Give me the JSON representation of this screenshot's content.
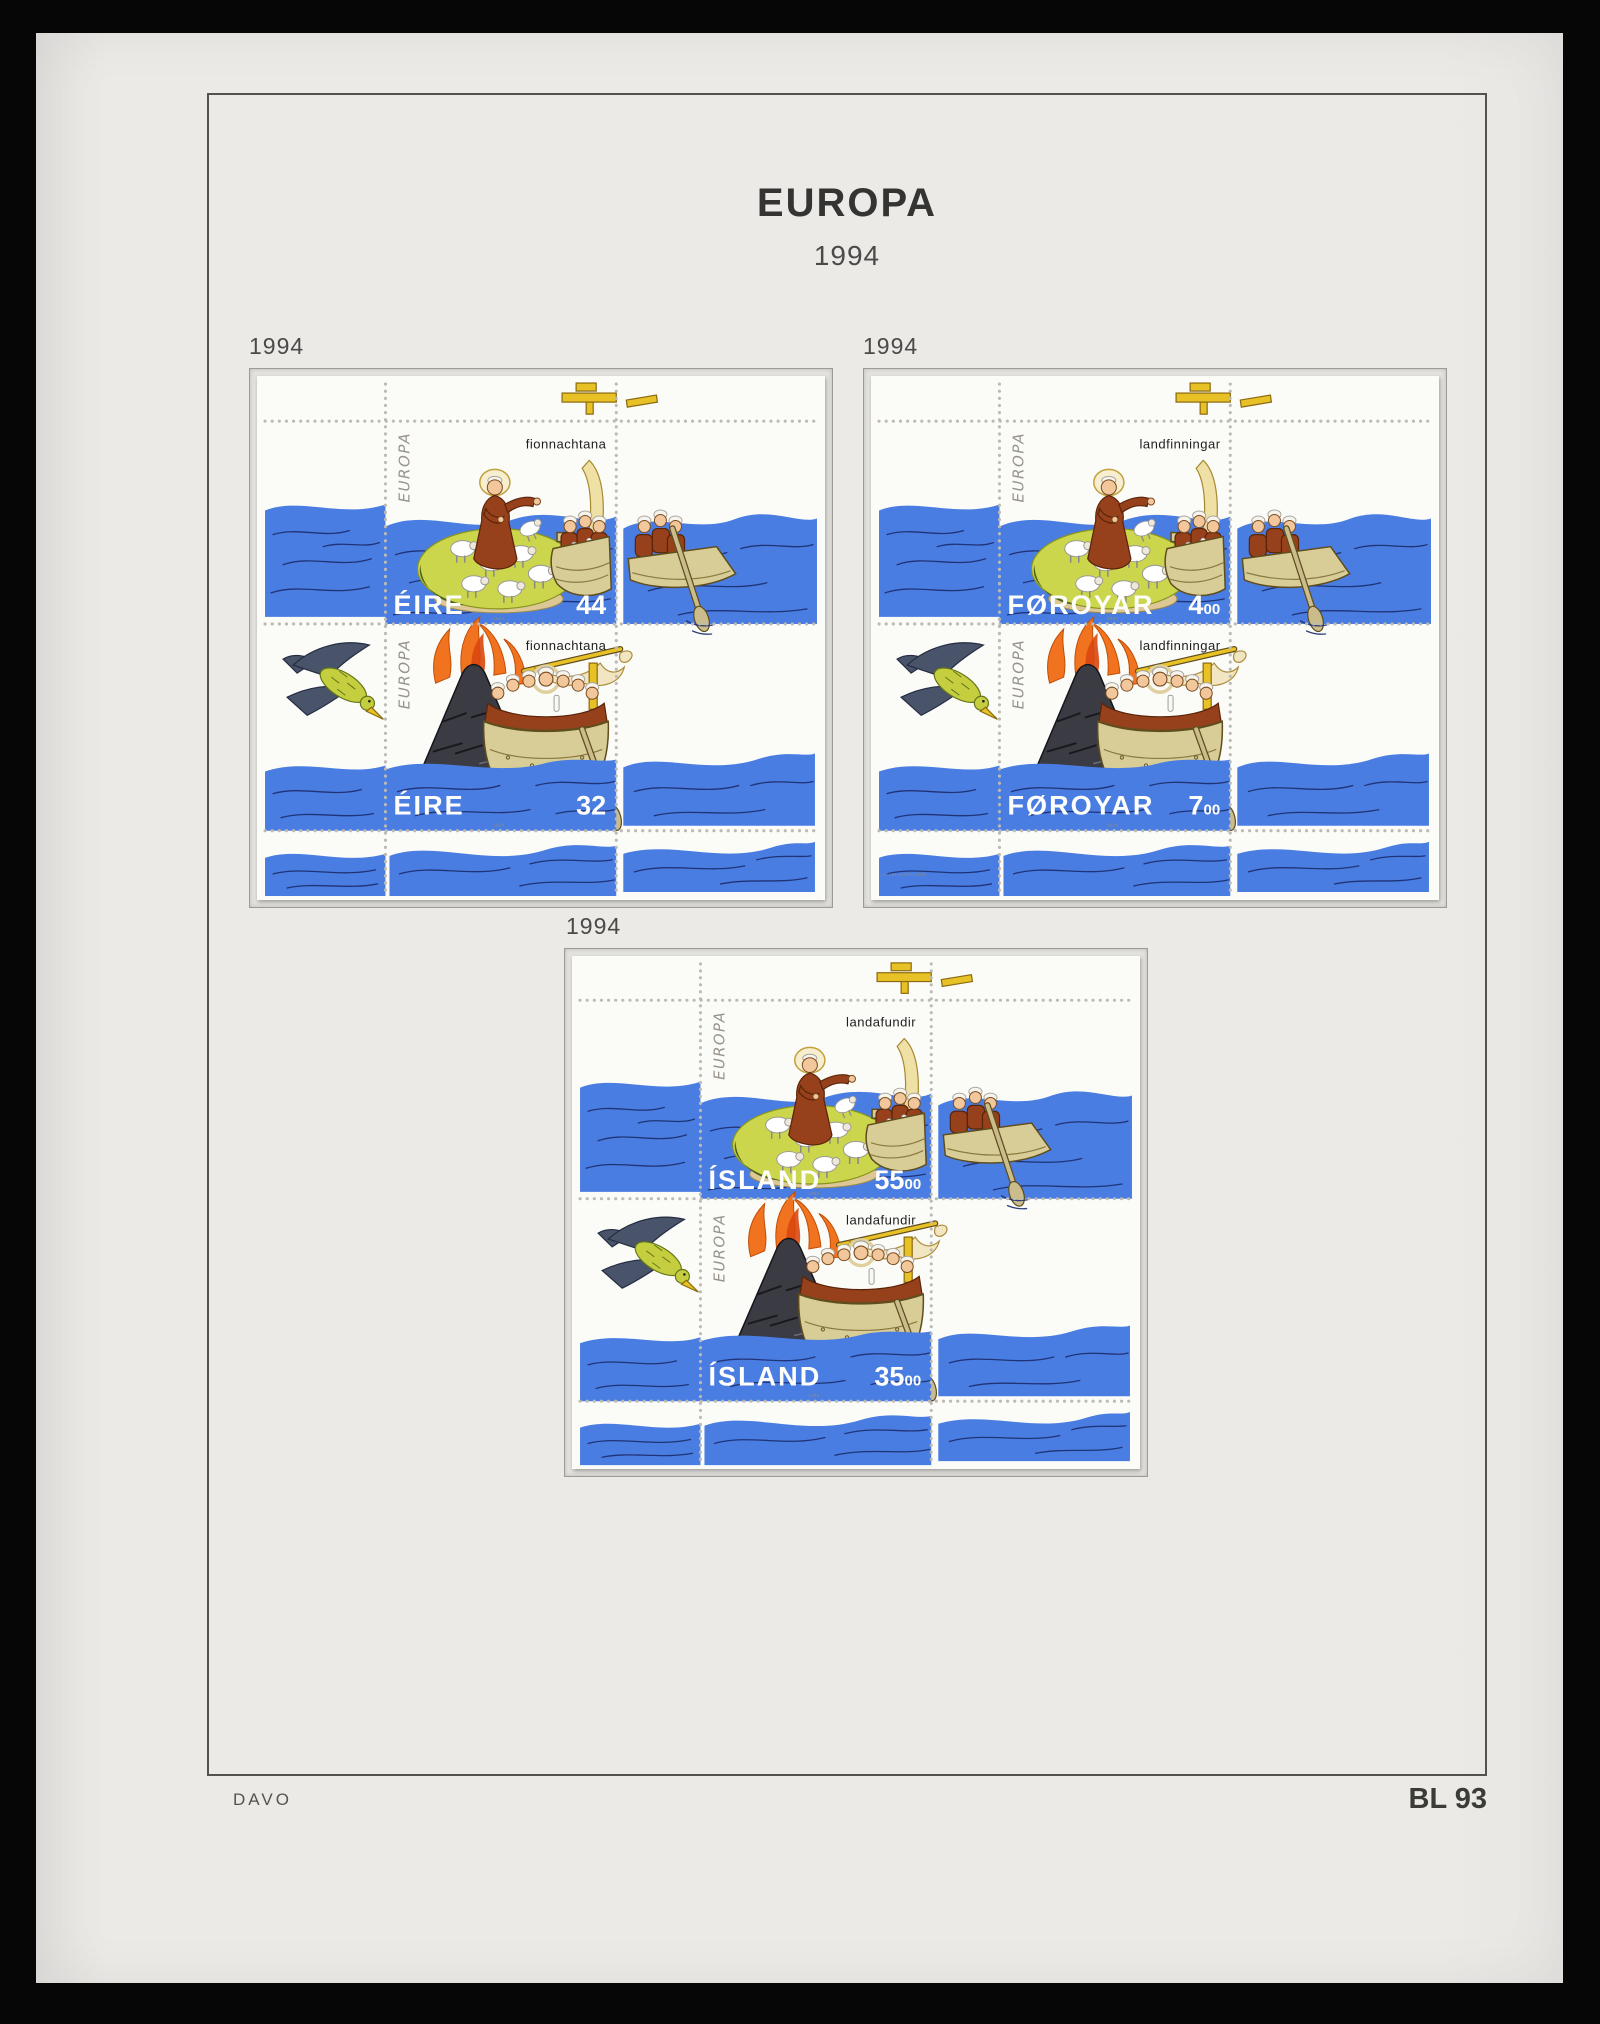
{
  "page": {
    "title": "EUROPA",
    "subtitle": "1994",
    "publisher_mark": "DAVO",
    "page_number": "BL 93"
  },
  "artwork": {
    "europa_logo": "EUROPA"
  },
  "colors": {
    "page_paper": "#eceae7",
    "sheet_white": "#fbfbf8",
    "sea_blue": "#4a7de2",
    "wave_line": "#1c2b6b",
    "island_green": "#ccd64c",
    "robe_brown": "#96411b",
    "boat_tan": "#d9cd97",
    "flame_orange": "#f2731f",
    "volcano_gray": "#3b3b43",
    "gold_yellow": "#e7c125"
  },
  "blocks": [
    {
      "year_label": "1994",
      "country": "ÉIRE",
      "micro_year": "1994",
      "designer": "",
      "stamps": [
        {
          "caption": "fionnachtana",
          "value_main": "44",
          "value_sub": ""
        },
        {
          "caption": "fionnachtana",
          "value_main": "32",
          "value_sub": ""
        }
      ]
    },
    {
      "year_label": "1994",
      "country": "FØROYAR",
      "micro_year": "1994",
      "designer": "COLIN HARRISON",
      "stamps": [
        {
          "caption": "landfinningar",
          "value_main": "4",
          "value_sub": "00"
        },
        {
          "caption": "landfinningar",
          "value_main": "7",
          "value_sub": "00"
        }
      ]
    },
    {
      "year_label": "1994",
      "country": "ÍSLAND",
      "micro_year": "1994",
      "designer": "",
      "stamps": [
        {
          "caption": "landafundir",
          "value_main": "55",
          "value_sub": "00"
        },
        {
          "caption": "landafundir",
          "value_main": "35",
          "value_sub": "00"
        }
      ]
    }
  ]
}
